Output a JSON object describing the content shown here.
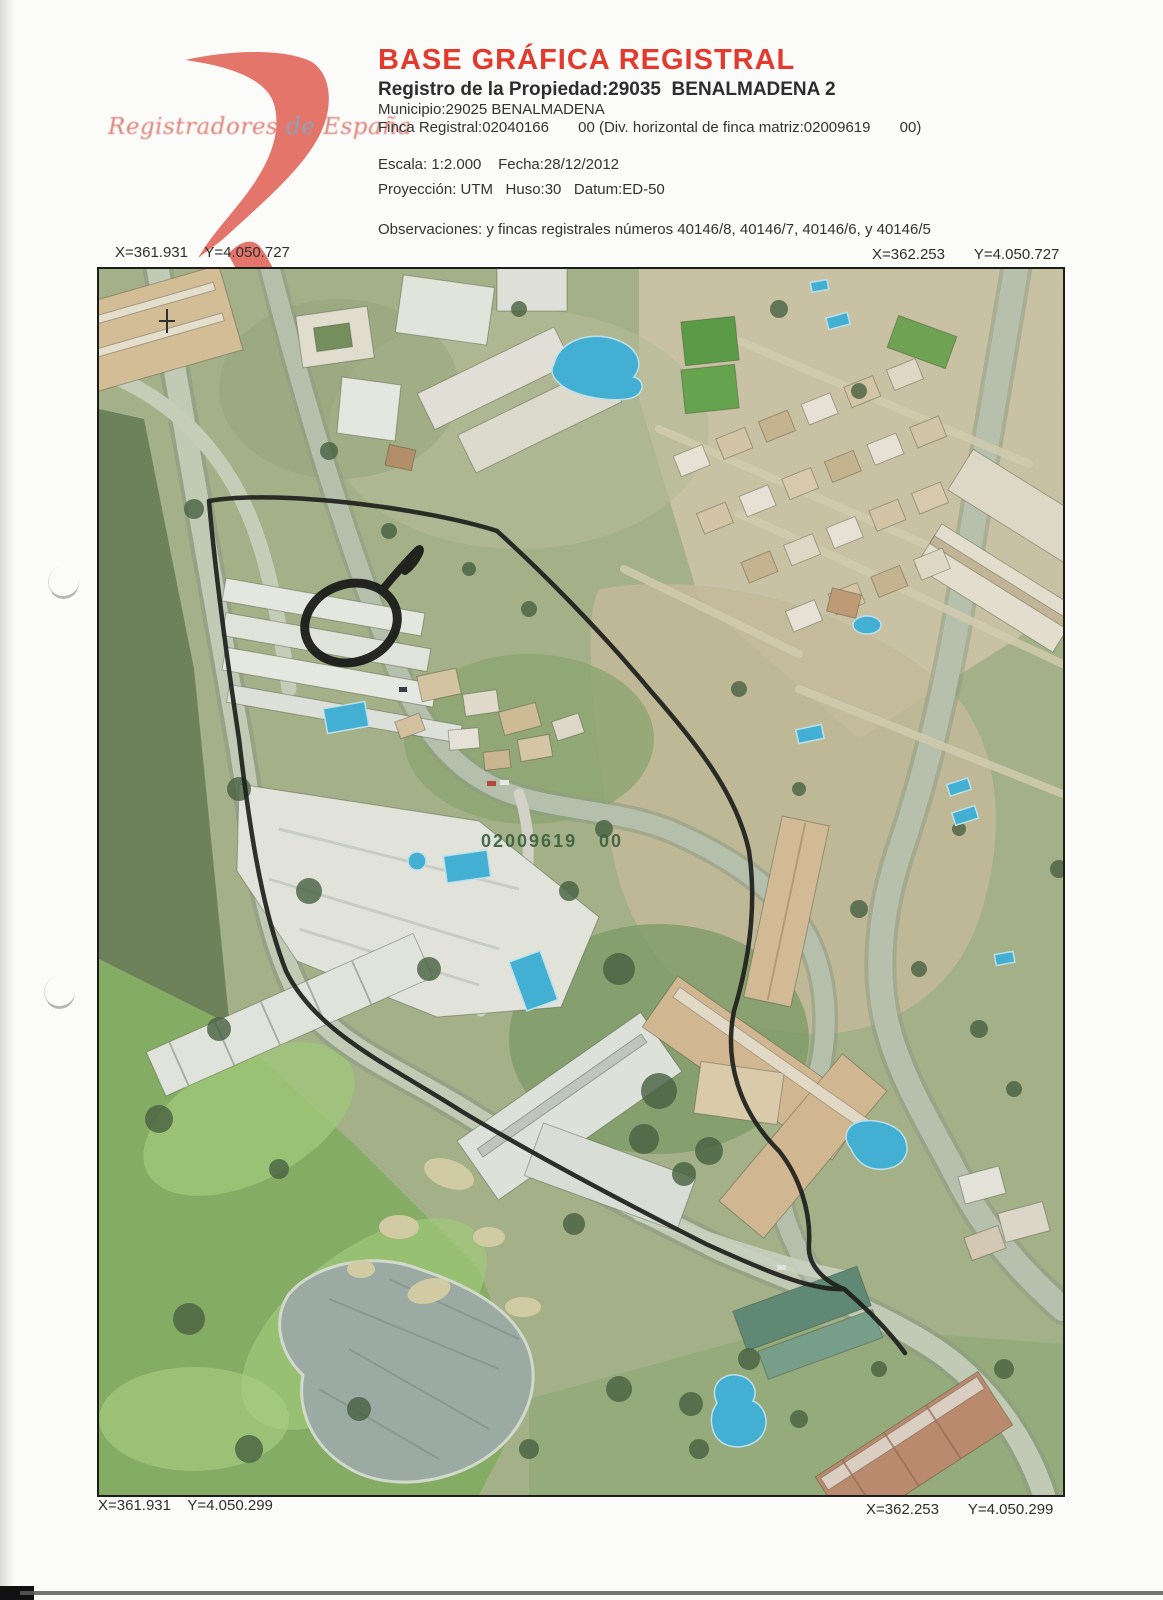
{
  "logo": {
    "name": "Registradores de España",
    "mark_color": "#e26a60",
    "text_part1": "Registradores",
    "text_part2": " de ",
    "text_part3": "España"
  },
  "header": {
    "title": "BASE GRÁFICA REGISTRAL",
    "title_color": "#e23b2e",
    "registro": "Registro de la Propiedad:29035  BENALMADENA 2",
    "municipio": "Municipio:29025 BENALMADENA",
    "finca": "Finca Registral:02040166       00 (Div. horizontal de finca matriz:02009619       00)",
    "escala": "Escala: 1:2.000    Fecha:28/12/2012",
    "proyeccion": "Proyección: UTM   Huso:30   Datum:ED-50",
    "observaciones": "Observaciones: y fincas registrales números 40146/8, 40146/7, 40146/6, y 40146/5"
  },
  "map": {
    "type": "aerial-orthophoto",
    "corner_coords": {
      "top_left": "X=361.931    Y=4.050.727",
      "top_right": "X=362.253       Y=4.050.727",
      "bottom_left": "X=361.931    Y=4.050.299",
      "bottom_right": "X=362.253       Y=4.050.299"
    },
    "overlay_label": {
      "number": "02009619",
      "suffix": "00",
      "color": "#2d5a33"
    },
    "annotations": {
      "boundary": "property-boundary-outline",
      "loop": "hand-drawn-loop"
    },
    "colors": {
      "pool": "#2fb3de",
      "vegetation": "#7fae58",
      "scrub": "#c6bd96",
      "road": "#c3cfb6",
      "building_tan": "#d9bd92",
      "building_white": "#eaece3",
      "lake": "#9aaba3",
      "boundary_ink": "#0f0f0d"
    }
  }
}
